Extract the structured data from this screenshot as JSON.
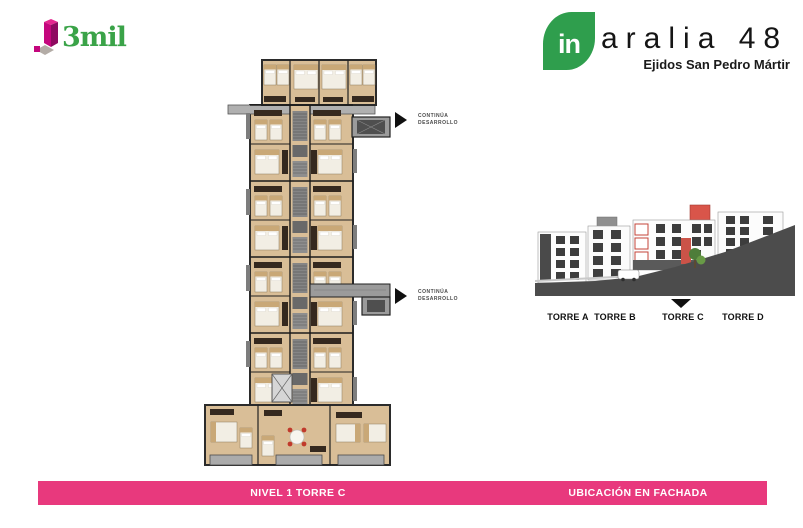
{
  "slide": {
    "brand_3mil": {
      "wordmark": "3mil",
      "colors": {
        "magenta": "#c4067d",
        "magenta_dark": "#8e0a60",
        "magenta_light": "#e5268f",
        "green": "#3aa348",
        "gray_tile": "#b3aca6"
      }
    },
    "brand_aralia": {
      "badge": "in",
      "title": "aralia 48",
      "subtitle": "Ejidos San Pedro Mártir",
      "badge_color": "#2f9e4d"
    },
    "plan": {
      "annotations": [
        "CONTINÚA DESARROLLO",
        "CONTINÚA DESARROLLO"
      ]
    },
    "facade": {
      "towers": [
        {
          "label": "TORRE A"
        },
        {
          "label": "TORRE B"
        },
        {
          "label": "TORRE C"
        },
        {
          "label": "TORRE D"
        }
      ],
      "highlighted_tower": "TORRE C"
    },
    "footer": {
      "plan_caption": "NIVEL 1 TORRE C",
      "facade_caption": "UBICACIÓN EN FACHADA",
      "bar_color": "#e8397d"
    }
  }
}
